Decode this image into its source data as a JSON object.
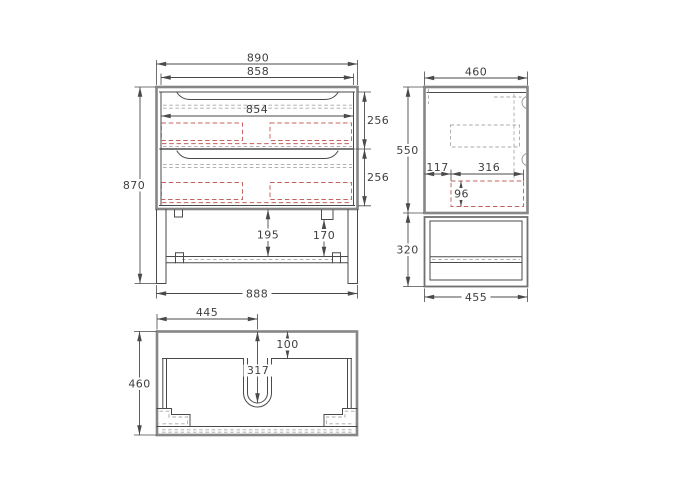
{
  "drawing_title": "vanity-cabinet-technical-drawing",
  "front_view": {
    "overall_width": "890",
    "top_width": "858",
    "drawer_width": "854",
    "drawer1_height": "256",
    "drawer2_height": "256",
    "overall_height": "870",
    "base_inner_height": "195",
    "shelf_height": "170",
    "base_width": "888"
  },
  "side_view": {
    "depth": "460",
    "cabinet_height": "550",
    "cutout_offset": "117",
    "cutout_width": "316",
    "cutout_height": "96",
    "base_height": "320",
    "base_depth": "455"
  },
  "bottom_view": {
    "center_offset": "445",
    "front_rail_depth": "100",
    "cutout_depth": "317",
    "depth": "460"
  },
  "colors": {
    "outline_heavy": "#868686",
    "outline": "#4a4a4a",
    "hidden_gray": "#a8a8a8",
    "hidden_red": "#c4625f",
    "text": "#3f3f3f",
    "background": "#ffffff"
  }
}
